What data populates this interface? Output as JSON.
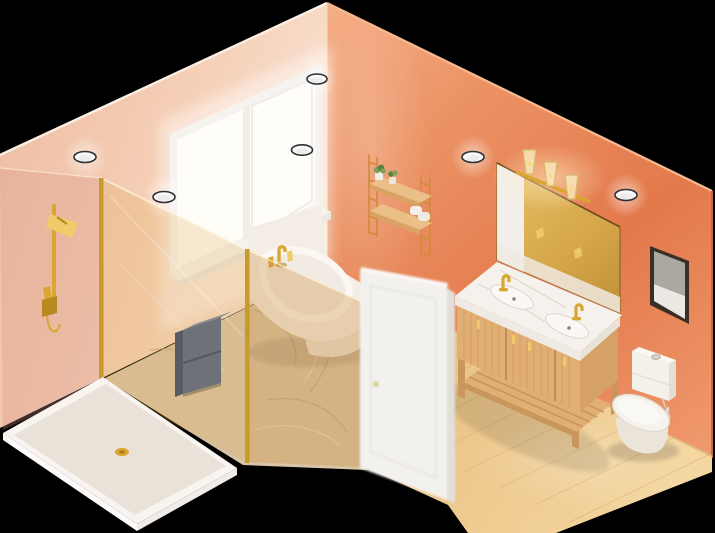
{
  "scene": {
    "title": "Isometric 3D render of a bathroom",
    "style": "isometric cutaway, no text, transparent-black background",
    "background": "#000000"
  },
  "palette": {
    "background": "#000000",
    "wall_left": "#F3C7AC",
    "wall_left_light": "#FBE9DC",
    "wall_right": "#E8895C",
    "wall_right_light": "#F5AE85",
    "wall_right_deep": "#E3794B",
    "floor_wood": "#EDC98E",
    "floor_wood_light": "#F4D7A0",
    "floor_wood_dark": "#DCB173",
    "marble_floor": "#D8C4A6",
    "marble_vein": "#B99F7E",
    "gold": "#D9A631",
    "gold_light": "#F0CB6A",
    "gold_dark": "#B8891F",
    "glass_amber": "rgba(222,166,74,0.24)",
    "glass_amber_deep": "rgba(205,140,55,0.32)",
    "glass_pink": "rgba(214,148,134,0.30)",
    "tray": "#EFE8E1",
    "tray_rim": "#F8F4F0",
    "white_fixture": "#F4F0EA",
    "fixture_shadow": "#DAD3C8",
    "cabinet_gray": "#6E7278",
    "cabinet_gray_top": "#8A8E94",
    "cabinet_gray_dark": "#585C62",
    "vanity_wood": "#E1AE73",
    "vanity_wood_dark": "#C9965C",
    "vanity_wood_side": "#D5A167",
    "counter_marble": "#F5F2ED",
    "mirror_amber": "#D4A448",
    "mirror_reflect": "#F2EFEA",
    "door_white": "#F3F1EE",
    "door_edge": "#E2DFD9",
    "door_knob": "#CBD14F",
    "frame_dark": "#3A2E25",
    "art_gray": "#ABA8A2",
    "art_white": "#ECE9E4",
    "window_glass": "#FFFDF8",
    "window_frame": "#F6F3EF",
    "plant_green": "#7CA257",
    "plant_green_dark": "#5E8040",
    "light_face": "#FAF9F7",
    "light_rim": "#2F3036"
  },
  "objects": {
    "room": {
      "label": "Isometric bathroom cutaway render"
    },
    "left_wall": {
      "label": "Peach wall with window"
    },
    "right_wall": {
      "label": "Coral accent wall"
    },
    "floor_wood": {
      "label": "Light oak wood floor"
    },
    "floor_marble": {
      "label": "Marble floor in shower and tub area"
    },
    "window": {
      "label": "White-framed sliding window, bright daylight",
      "panes": 2
    },
    "ceiling_lights": {
      "label": "Recessed ceiling spotlights",
      "count": 6
    },
    "shower_glass": {
      "label": "Walk-in shower glass enclosure with gold frame"
    },
    "shower_head": {
      "label": "Gold shower head with hand sprayer and slide bar"
    },
    "shower_tray": {
      "label": "White shower tray with gold drain"
    },
    "shower_cabinet": {
      "label": "Dark gray wall-mounted shower cabinet",
      "drawers": 2
    },
    "bathtub": {
      "label": "White corner bathtub under window"
    },
    "tub_faucet": {
      "label": "Gold deck-mounted tub faucet set",
      "pieces": 3
    },
    "door": {
      "label": "White door standing open",
      "knob": "small brass-green knob"
    },
    "vanity": {
      "label": "Oak double vanity with marble top and open slat shelf",
      "sinks": 2,
      "faucets": 2
    },
    "vanity_faucets": {
      "label": "Gold widespread basin faucets"
    },
    "mirror": {
      "label": "Large gold-tinted vanity mirror reflecting the door"
    },
    "sconce": {
      "label": "Three-light glass and gold vanity sconce",
      "bulbs": 3
    },
    "wall_shelf": {
      "label": "Two-tier wood wall shelf with ladder sides",
      "tiers": 2
    },
    "plants": {
      "label": "Two potted succulents on shelf",
      "count": 2
    },
    "towels": {
      "label": "Rolled white towels on lower shelf"
    },
    "toilet": {
      "label": "White one-piece toilet with top flush button"
    },
    "artwork": {
      "label": "Framed abstract artwork on coral wall"
    }
  }
}
